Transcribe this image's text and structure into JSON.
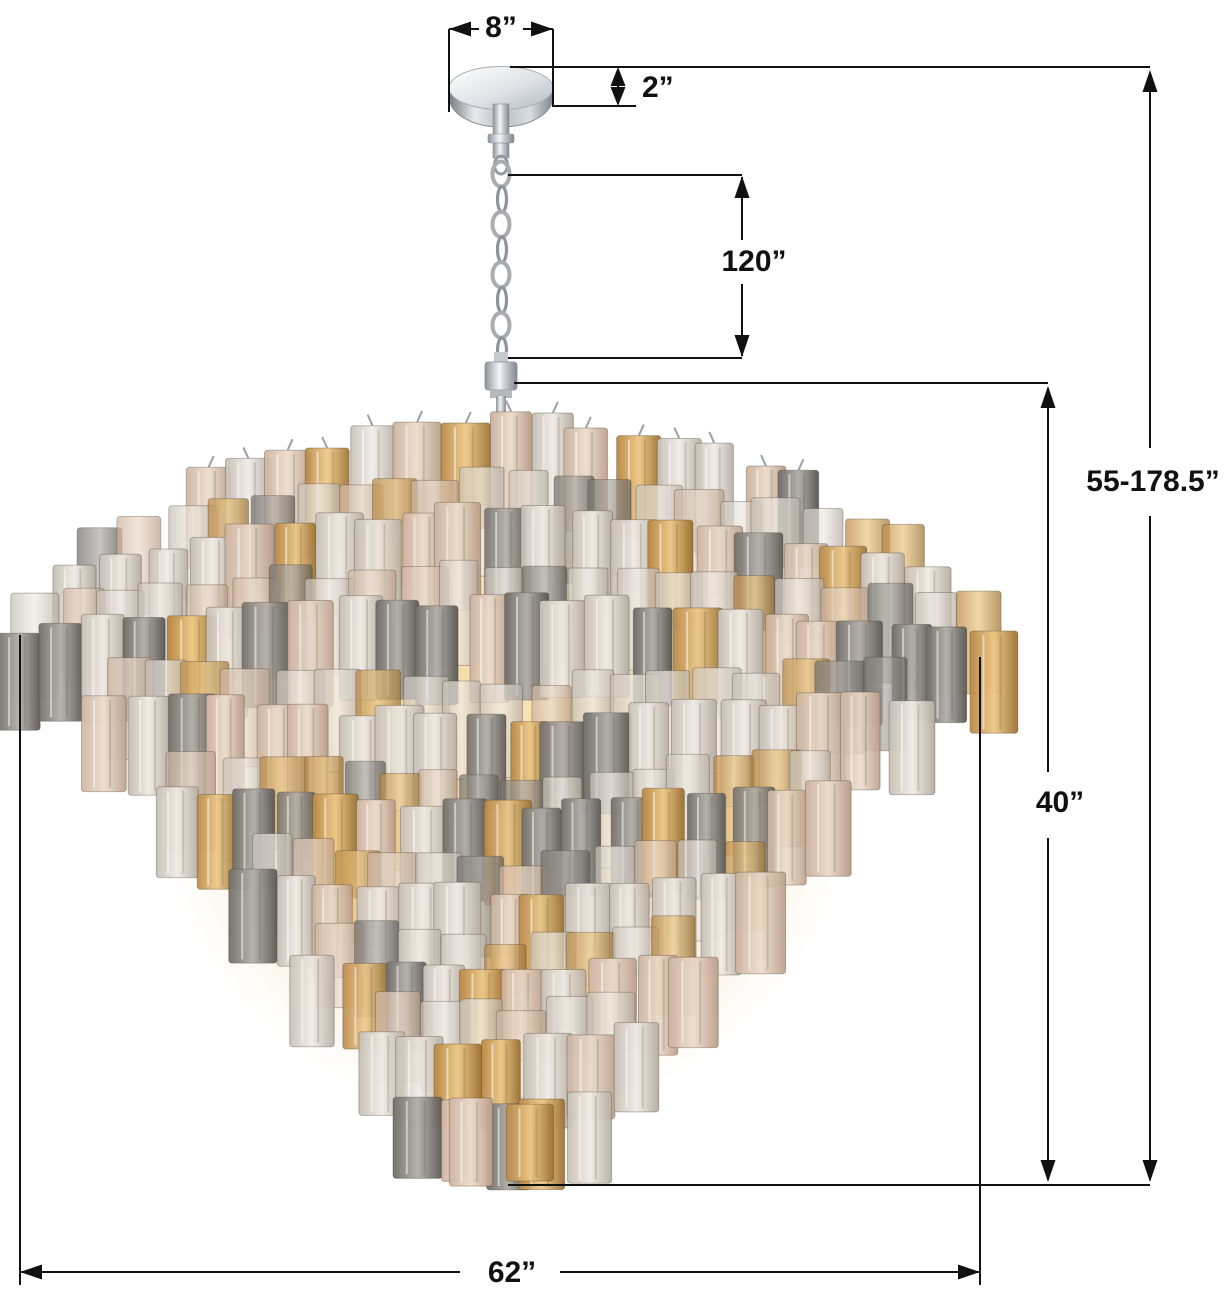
{
  "diagram": {
    "labels": {
      "canopy_width": "8”",
      "canopy_height": "2”",
      "chain_length": "120”",
      "overall_height": "55-178.5”",
      "fixture_height": "40”",
      "fixture_width": "62”"
    },
    "style": {
      "line_color": "#111111",
      "background": "#ffffff",
      "chrome": "#c9ced4",
      "glass_clear": "#e8e3dc",
      "glass_champagne": "#e3d2c1",
      "glass_smoke": "#8d8a85",
      "glass_amber": "#c99a55",
      "glow": "#eccf92"
    }
  }
}
